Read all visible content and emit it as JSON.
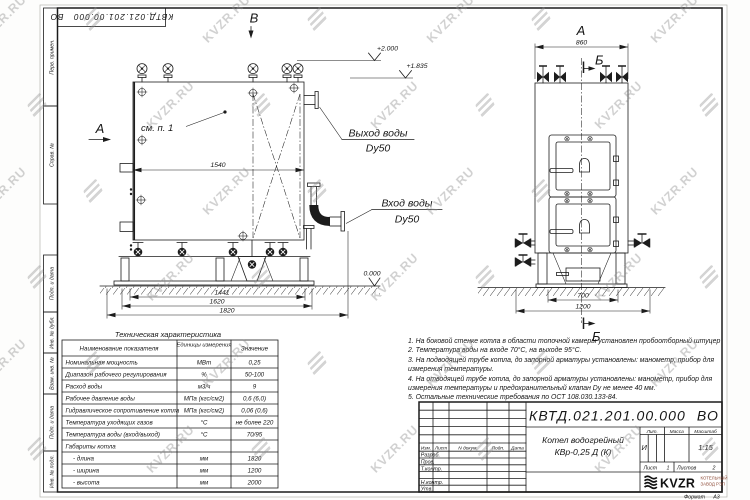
{
  "watermark": {
    "text": "KVZR.RU"
  },
  "margin_labels": [
    "Перв. примен.",
    "Справ. №",
    "Подп. и дата",
    "Инв. № дубл.",
    "Взам. инв. №",
    "Подп. и дата",
    "Инв. № подл."
  ],
  "drawing": {
    "views": {
      "front_letter_left": "А",
      "top_letter": "В",
      "side_letter_top": "А",
      "section_letter_top": "Б",
      "section_letter_bottom": "Б"
    },
    "callouts": {
      "see_note": "см. п. 1",
      "water_outlet_line1": "Выход воды",
      "water_outlet_line2": "Dy50",
      "water_inlet_line1": "Вход воды",
      "water_inlet_line2": "Dy50"
    },
    "elevations": {
      "top": "+2.000",
      "outlet": "+1.835",
      "ground": "0.000"
    },
    "dimensions": {
      "front_inner_width": "1540",
      "front_base_1": "1441",
      "front_base_2": "1620",
      "front_overall": "1820",
      "side_top": "860",
      "side_base_1": "700",
      "side_base_2": "1200"
    }
  },
  "tech_table": {
    "title": "Техническая характеристика",
    "headers": [
      "Наименование показателя",
      "Единицы измерения",
      "Значение"
    ],
    "rows": [
      {
        "name": "Номинальная мощность",
        "unit": "МВт",
        "value": "0,25"
      },
      {
        "name": "Диапазон рабочего регулирования",
        "unit": "%",
        "value": "50-100"
      },
      {
        "name": "Расход воды",
        "unit": "м3/ч",
        "value": "9"
      },
      {
        "name": "Рабочее давление воды",
        "unit": "МПа (кгс/см2)",
        "value": "0,6 (6,0)"
      },
      {
        "name": "Гидравлическое сопротивление котла",
        "unit": "МПа (кгс/см2)",
        "value": "0,06 (0,6)"
      },
      {
        "name": "Температура уходящих газов",
        "unit": "°С",
        "value": "не более 220"
      },
      {
        "name": "Температура воды (вход/выход)",
        "unit": "°С",
        "value": "70/95"
      },
      {
        "name": "Габариты котла",
        "unit": "",
        "value": ""
      },
      {
        "name": "- длина",
        "unit": "мм",
        "value": "1820"
      },
      {
        "name": "- ширина",
        "unit": "мм",
        "value": "1200"
      },
      {
        "name": "- высота",
        "unit": "мм",
        "value": "2000"
      }
    ]
  },
  "notes": [
    "1. На боковой стенке котла в области топочной камеры установлен пробоотборный штуцер",
    "2. Температура воды на входе 70°С, на выходе 95°С.",
    "3. На подводящей трубе котла, до запорной арматуры установлены: манометр, прибор для измерения температуры.",
    "4. На отводящей трубе котла, до запорной арматуры установлены: манометр, прибор для измерения температуры и предохранительный клапан Dу не менее 40 мм.",
    "5. Остальные технические требования по ОСТ 108.030.133-84."
  ],
  "title_block": {
    "doc_number": "КВТД.021.201.00.000 ВО",
    "product_line1": "Котел водогрейный",
    "product_line2": "КВр-0,25 Д (К)",
    "change_cols": {
      "izm": "Изм.",
      "list": "Лист",
      "doc": "N докум.",
      "sign": "Подп.",
      "date": "Дата"
    },
    "roles": [
      "Разраб.",
      "Пров.",
      "Т.контр.",
      "",
      "Н.контр.",
      "Утв."
    ],
    "lit_label": "Лит.",
    "mass_label": "Масса",
    "scale_label": "Масштаб",
    "lit_value": "И",
    "scale_value": "1:15",
    "sheet_label": "Лист",
    "sheet_value": "1",
    "sheets_label": "Листов",
    "sheets_value": "2",
    "logo_text": "KVZR",
    "logo_sub_line1": "КОТЕЛЬНЫЙ",
    "logo_sub_line2": "ЗАВОД РЭП"
  },
  "format_label": "Формат",
  "format_value": "А3"
}
